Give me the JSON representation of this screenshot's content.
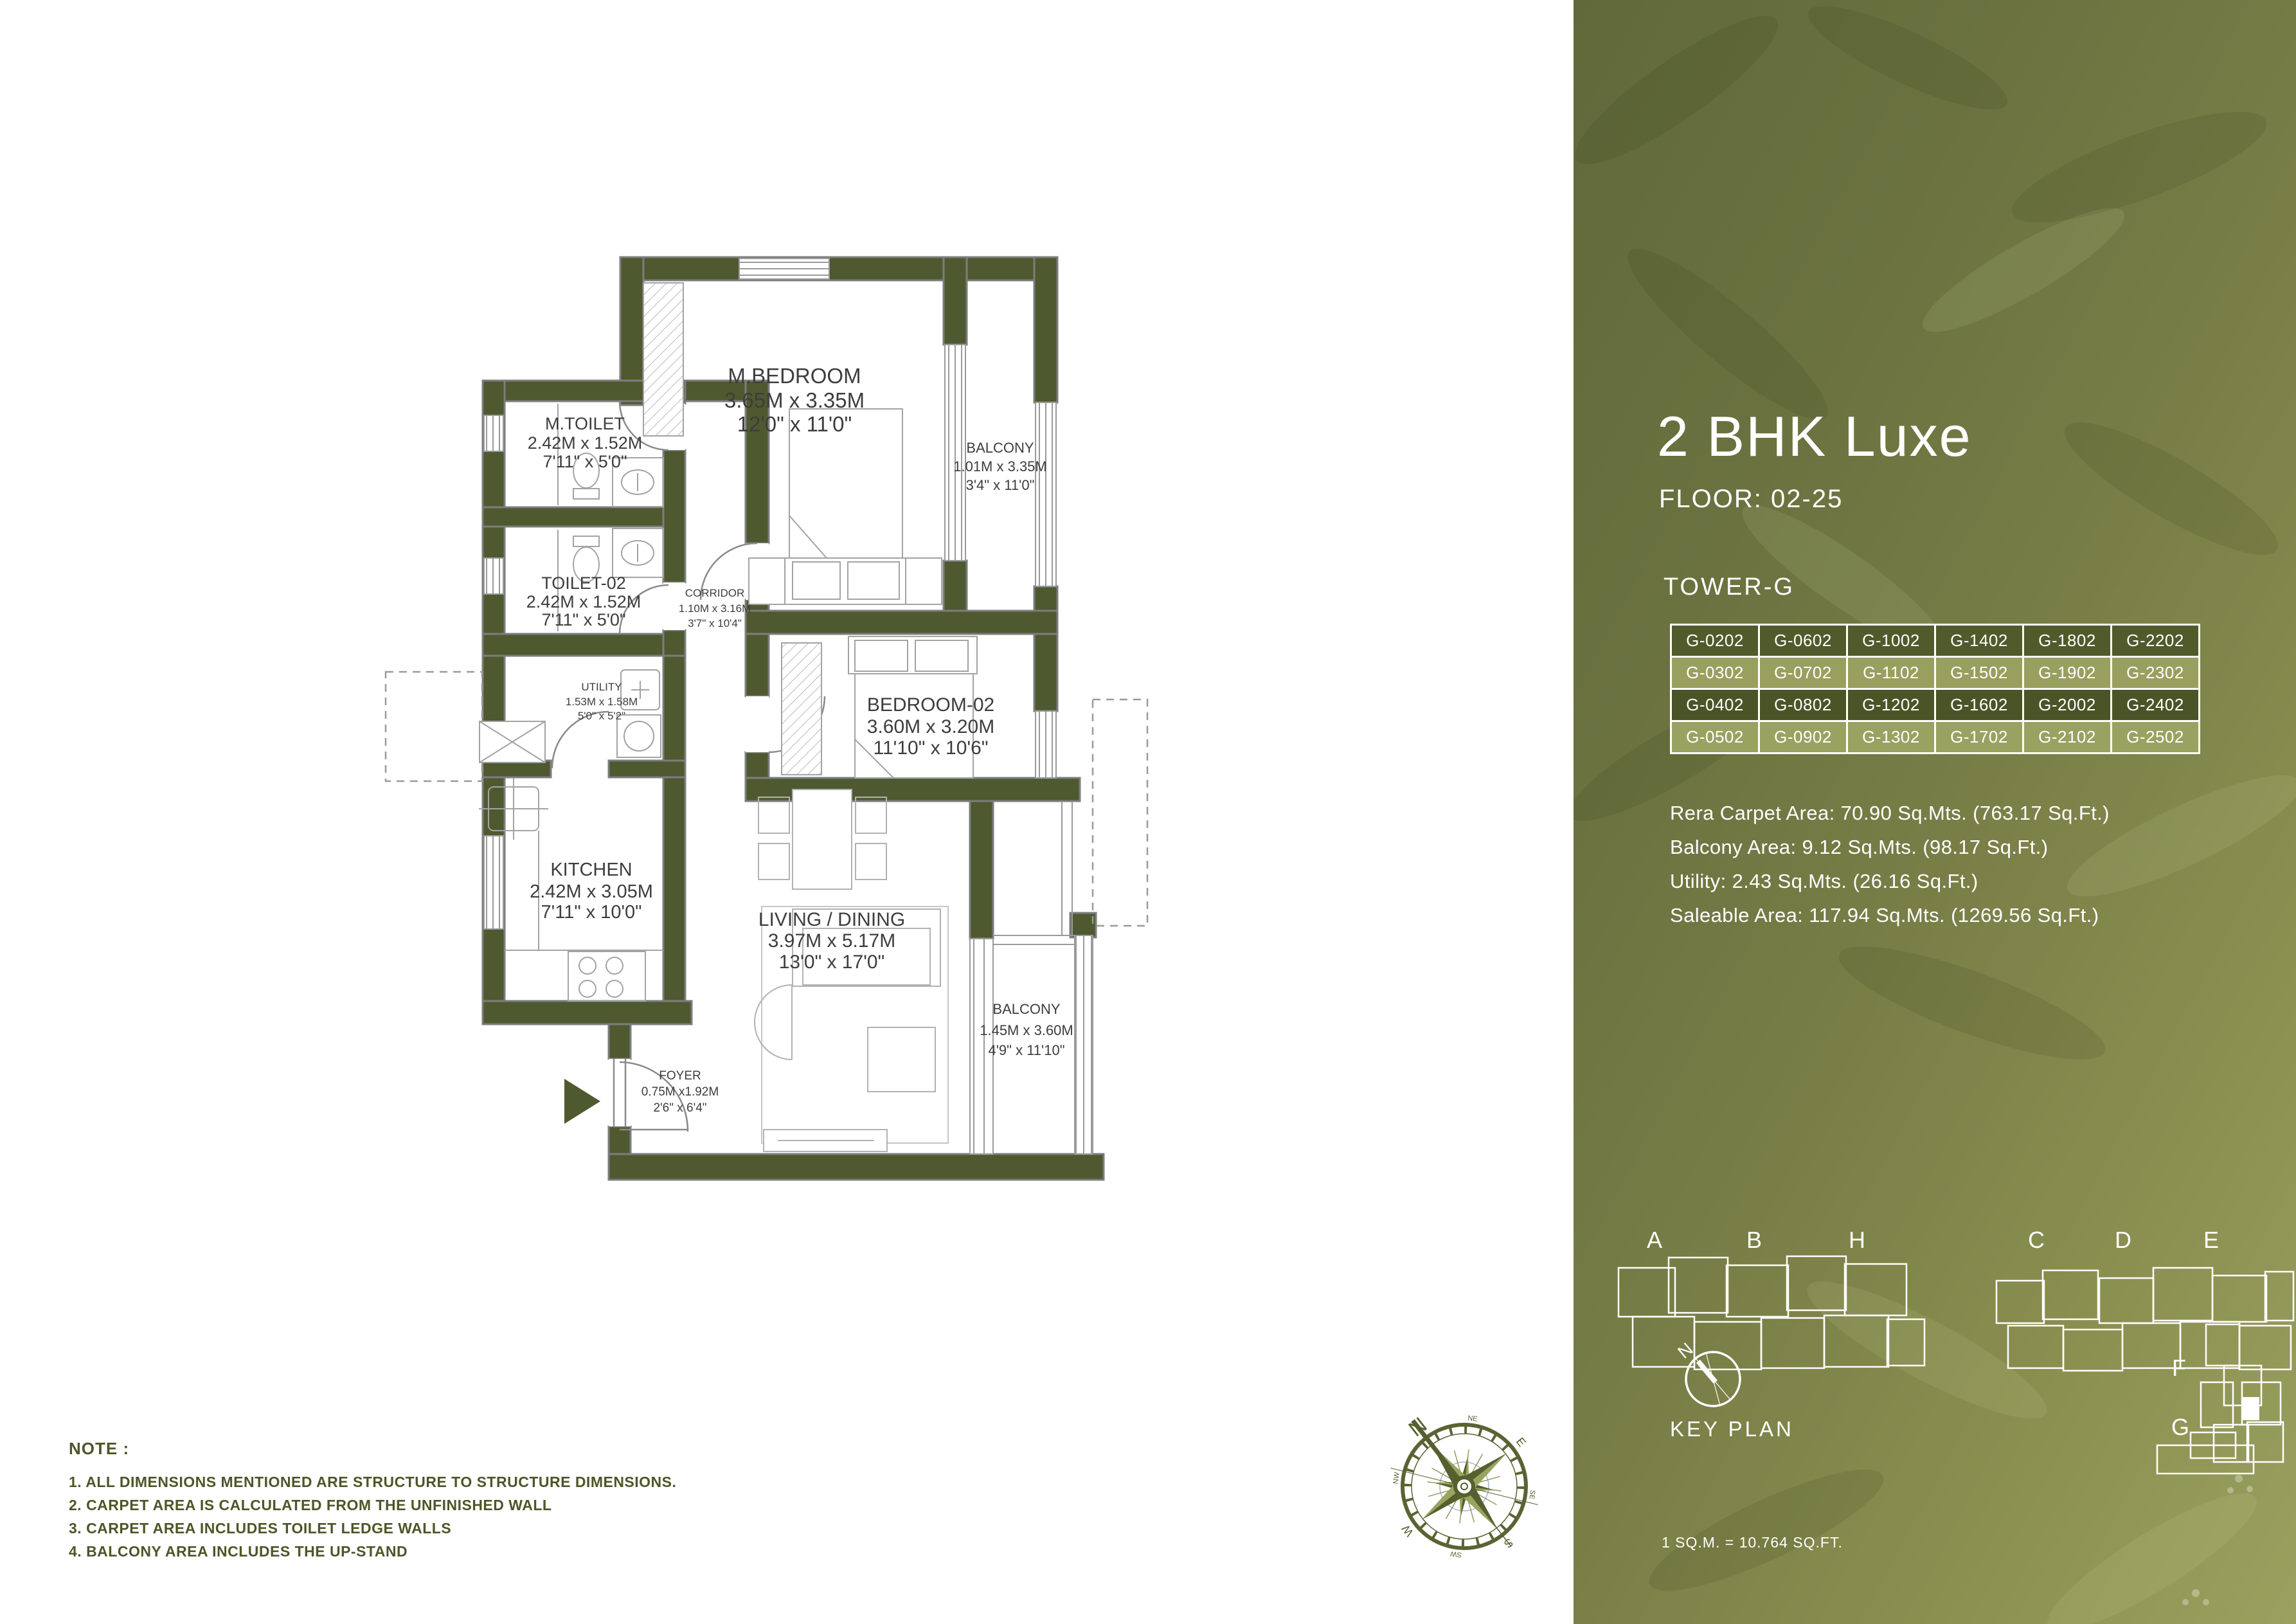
{
  "floor_plan": {
    "rooms": {
      "m_bedroom": {
        "name": "M.BEDROOM",
        "metric": "3.65M x 3.35M",
        "imperial": "12'0\" x 11'0\""
      },
      "balcony_top": {
        "name": "BALCONY",
        "metric": "1.01M x 3.35M",
        "imperial": "3'4\" x 11'0\""
      },
      "m_toilet": {
        "name": "M.TOILET",
        "metric": "2.42M x 1.52M",
        "imperial": "7'11\" x 5'0\""
      },
      "toilet_02": {
        "name": "TOILET-02",
        "metric": "2.42M x 1.52M",
        "imperial": "7'11\" x 5'0\""
      },
      "corridor": {
        "name": "CORRIDOR",
        "metric": "1.10M x 3.16M",
        "imperial": "3'7\" x 10'4\""
      },
      "utility": {
        "name": "UTILITY",
        "metric": "1.53M x 1.58M",
        "imperial": "5'0\" x 5'2\""
      },
      "kitchen": {
        "name": "KITCHEN",
        "metric": "2.42M x 3.05M",
        "imperial": "7'11\" x 10'0\""
      },
      "bedroom_02": {
        "name": "BEDROOM-02",
        "metric": "3.60M x 3.20M",
        "imperial": "11'10\" x 10'6\""
      },
      "living": {
        "name": "LIVING / DINING",
        "metric": "3.97M x 5.17M",
        "imperial": "13'0\" x 17'0\""
      },
      "balcony_bottom": {
        "name": "BALCONY",
        "metric": "1.45M x 3.60M",
        "imperial": "4'9\" x 11'10\""
      },
      "foyer": {
        "name": "FOYER",
        "metric": "0.75M x1.92M",
        "imperial": "2'6\" x 6'4\""
      }
    },
    "compass": {
      "n": "N",
      "ne": "NE",
      "e": "E",
      "se": "SE",
      "s": "S",
      "sw": "SW",
      "w": "W",
      "nw": "NW"
    },
    "note": {
      "title": "NOTE :",
      "items": [
        "1. ALL DIMENSIONS MENTIONED ARE STRUCTURE TO STRUCTURE DIMENSIONS.",
        "2. CARPET AREA IS CALCULATED FROM THE UNFINISHED WALL",
        "3. CARPET AREA INCLUDES TOILET LEDGE WALLS",
        "4. BALCONY AREA INCLUDES THE UP-STAND"
      ]
    }
  },
  "panel": {
    "title": "2 BHK Luxe",
    "floor_label": "FLOOR: 02-25",
    "tower_label": "TOWER-G",
    "unit_table": {
      "rows": [
        [
          "G-0202",
          "G-0602",
          "G-1002",
          "G-1402",
          "G-1802",
          "G-2202"
        ],
        [
          "G-0302",
          "G-0702",
          "G-1102",
          "G-1502",
          "G-1902",
          "G-2302"
        ],
        [
          "G-0402",
          "G-0802",
          "G-1202",
          "G-1602",
          "G-2002",
          "G-2402"
        ],
        [
          "G-0502",
          "G-0902",
          "G-1302",
          "G-1702",
          "G-2102",
          "G-2502"
        ]
      ]
    },
    "area_lines": [
      "Rera Carpet Area: 70.90 Sq.Mts. (763.17 Sq.Ft.)",
      "Balcony Area: 9.12 Sq.Mts. (98.17 Sq.Ft.)",
      "Utility: 2.43 Sq.Mts. (26.16 Sq.Ft.)",
      "Saleable Area: 117.94 Sq.Mts. (1269.56 Sq.Ft.)"
    ],
    "key_plan": {
      "label": "KEY PLAN",
      "north_label": "N",
      "blocks": [
        "A",
        "B",
        "H",
        "C",
        "D",
        "E",
        "F",
        "G"
      ]
    },
    "conversion_note": "1 SQ.M. = 10.764 SQ.FT."
  },
  "colors": {
    "wall_olive": "#4f5930",
    "panel_green_dark": "#646c3b",
    "panel_green_light": "#9aa05e",
    "table_row_dark": "#4b5426",
    "table_row_light": "#99a05f",
    "plan_text": "#3d3d3d",
    "note_green": "#4d5628"
  }
}
